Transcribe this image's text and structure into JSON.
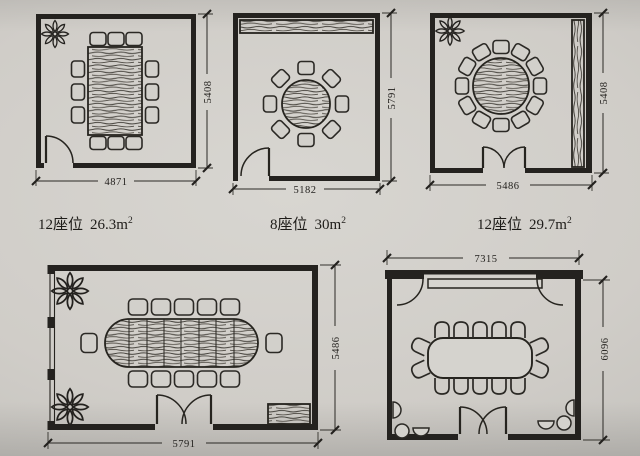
{
  "figure": {
    "plans": {
      "p1": {
        "caption_seats": "12座位",
        "caption_area": "26.3m",
        "caption_sup": "2",
        "caption_full": "12座位 26.3m²",
        "dim_width": "4871",
        "dim_height": "5408"
      },
      "p2": {
        "caption_seats": "8座位",
        "caption_area": "30m",
        "caption_sup": "2",
        "caption_full": "8座位 30m²",
        "dim_width": "5182",
        "dim_height": "5791"
      },
      "p3": {
        "caption_seats": "12座位",
        "caption_area": "29.7m",
        "caption_sup": "2",
        "caption_full": "12座位 29.7m²",
        "dim_width": "5486",
        "dim_height": "5408"
      },
      "p4": {
        "dim_width": "5791",
        "dim_height": "5486"
      },
      "p5": {
        "dim_width": "7315",
        "dim_height": "6096"
      }
    },
    "icons": {
      "flower": "flower-plant-icon",
      "single_door": "door-swing-icon",
      "double_door": "double-door-swing-icon",
      "window": "window-wall-icon",
      "sideboard": "sideboard-wood-icon",
      "cabinet": "cabinet-wood-icon",
      "chair": "chair-icon",
      "stool": "stool-bowl-icon"
    }
  }
}
